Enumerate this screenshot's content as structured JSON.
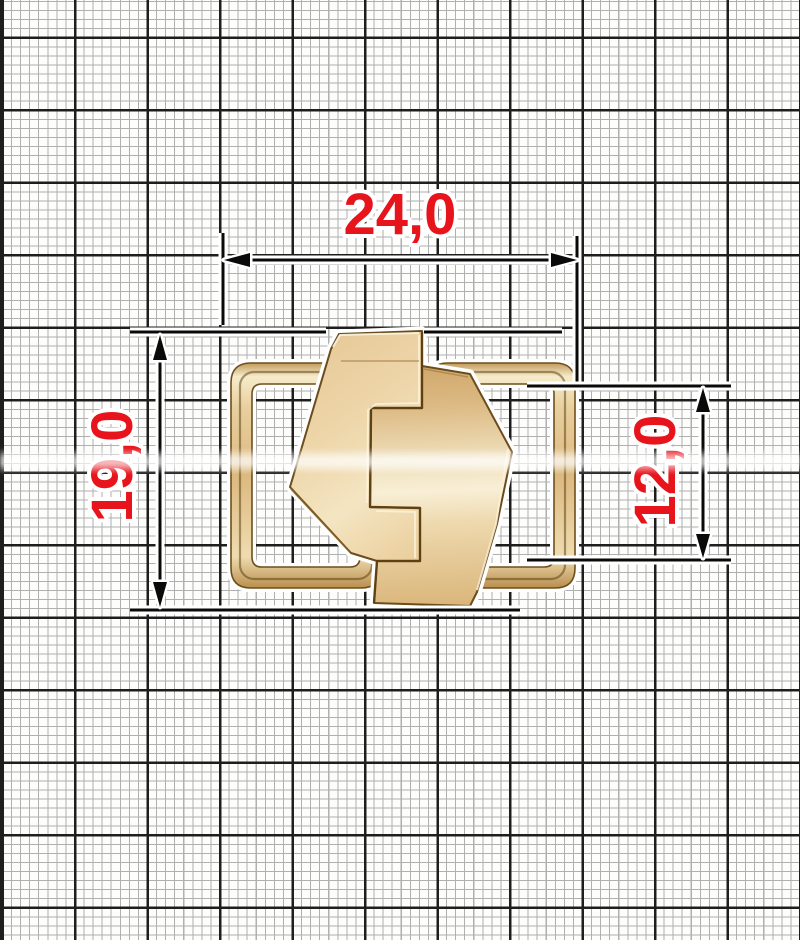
{
  "drawing": {
    "object": "gold metal clasp buckle with two interlocking hexagonal halves and side wire loops, shown on millimeter graph paper",
    "dimensions": {
      "width": {
        "label": "24,0"
      },
      "height": {
        "label": "19,0"
      },
      "loop_opening_height": {
        "label": "12,0"
      }
    },
    "colors": {
      "dimension_text": "#e8141b",
      "dimension_lines": "#0a0a0a",
      "metal_light": "#f8efd8",
      "metal_base": "#e6c795",
      "metal_shadow": "#8a6530",
      "grid_fine": "#b0b0b0",
      "grid_major": "#1e1e1e",
      "paper": "#fdfdfc"
    }
  }
}
